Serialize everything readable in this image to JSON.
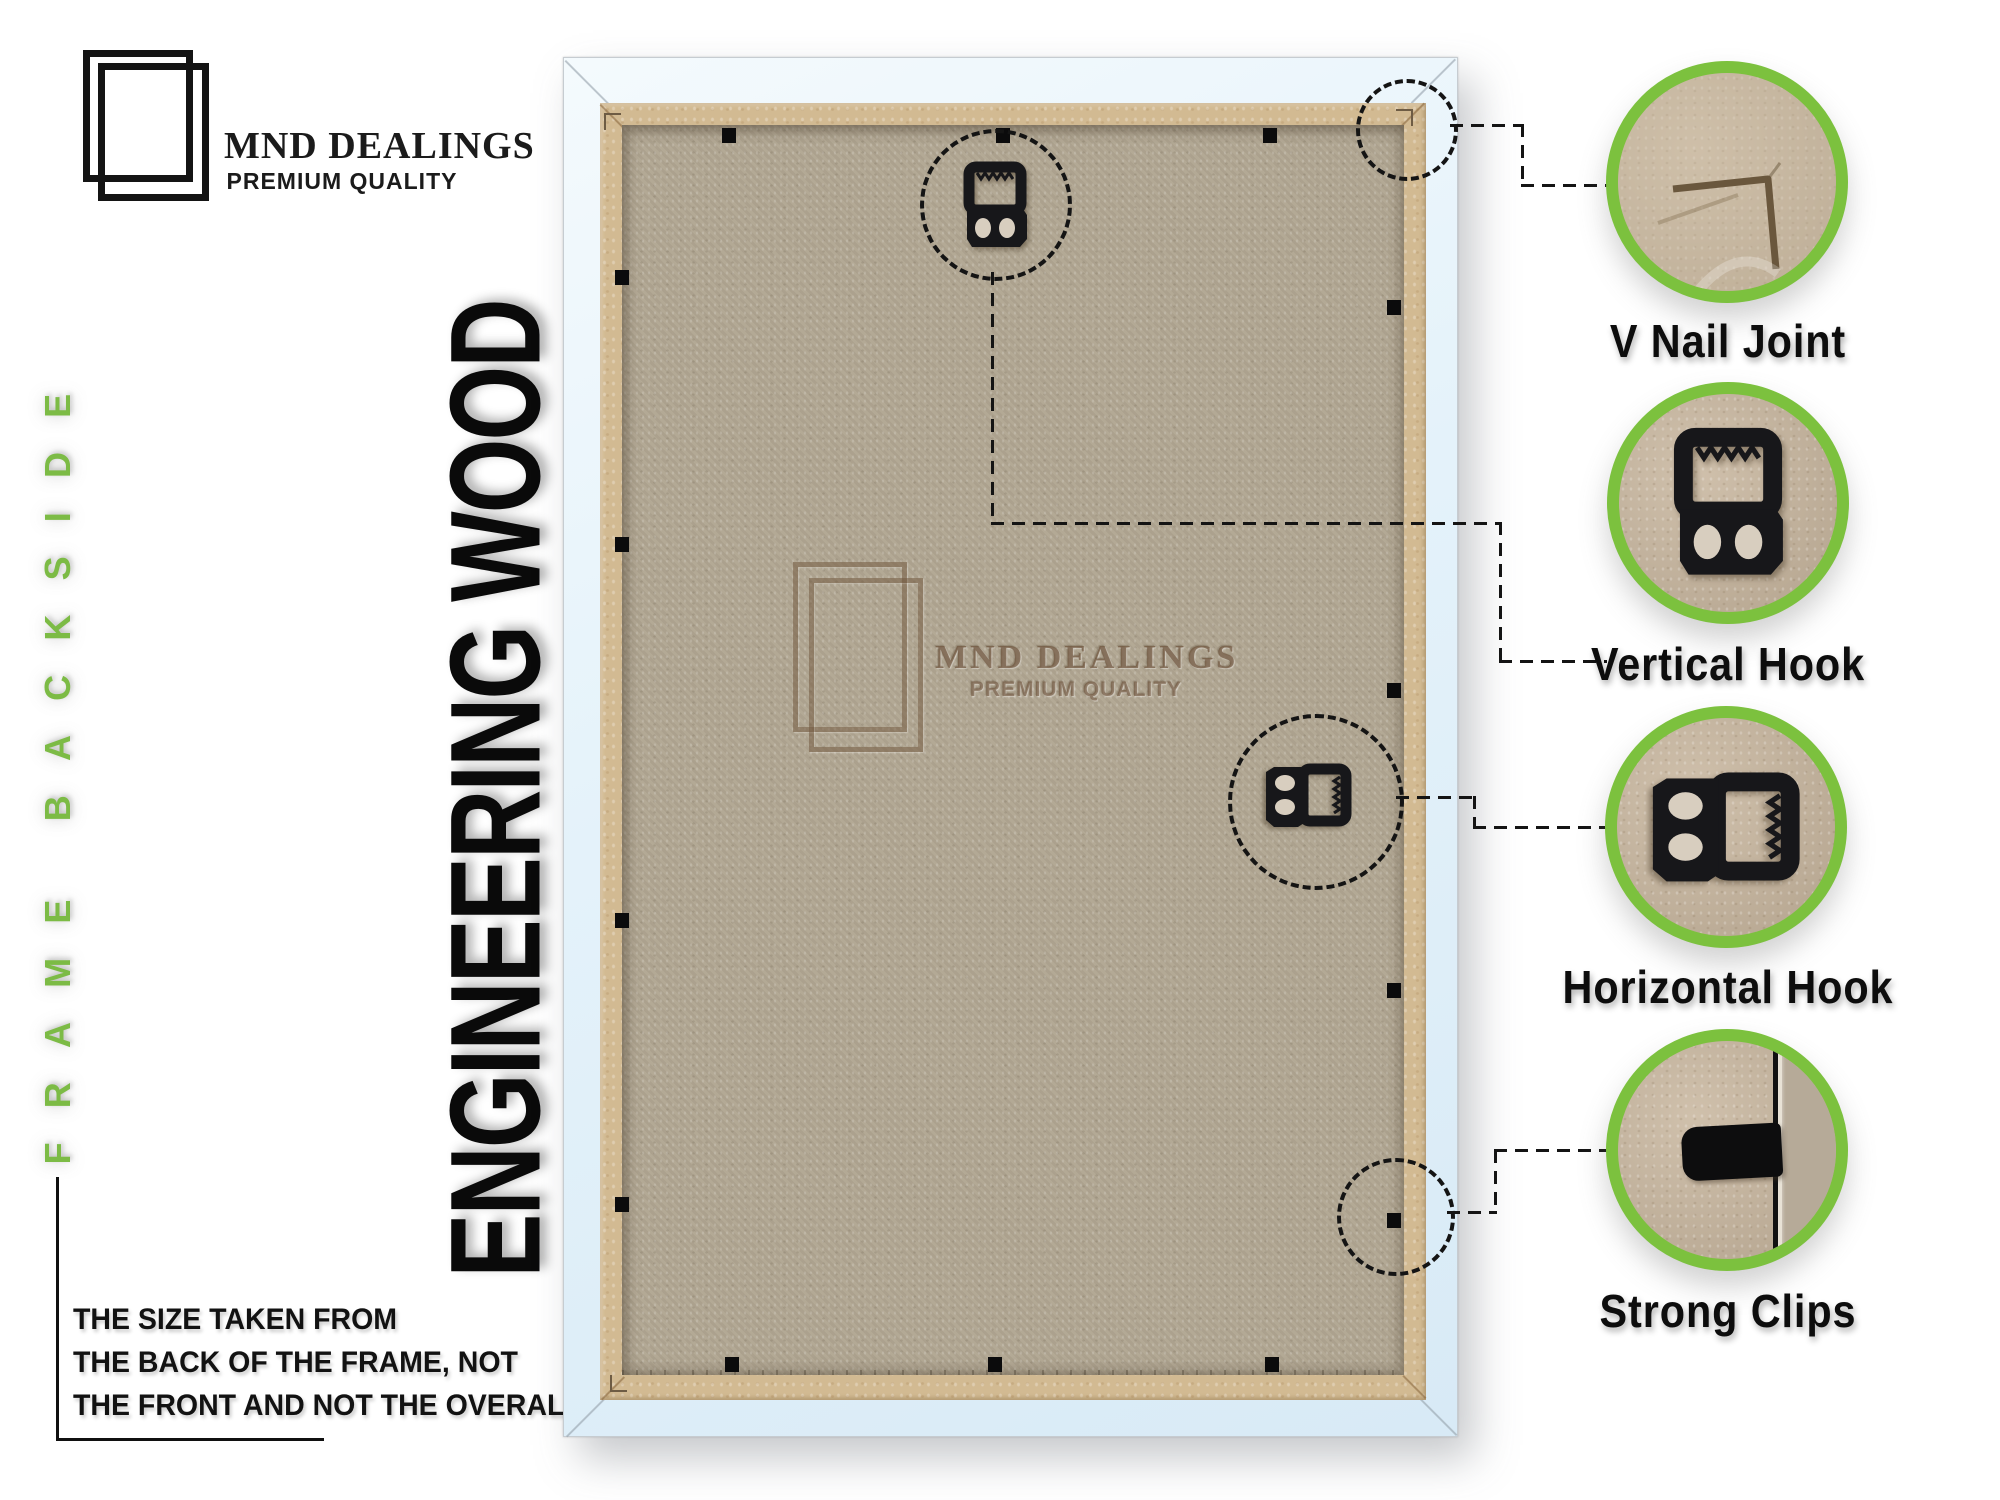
{
  "brand": {
    "name": "MND DEALINGS",
    "tagline": "PREMIUM QUALITY"
  },
  "side_label": "FRAME BACKSIDE",
  "headline": "ENGINEERING WOOD",
  "size_note": {
    "lines": [
      "THE SIZE TAKEN FROM",
      "THE BACK OF THE FRAME, NOT",
      "THE FRONT AND NOT THE OVERALL SIZE."
    ]
  },
  "watermark": {
    "name": "MND DEALINGS",
    "tagline": "PREMIUM QUALITY"
  },
  "callouts": [
    {
      "label": "V Nail Joint",
      "icon": "v-nail-joint-photo"
    },
    {
      "label": "Vertical Hook",
      "icon": "vertical-hook-photo"
    },
    {
      "label": "Horizontal Hook",
      "icon": "horizontal-hook-photo"
    },
    {
      "label": "Strong Clips",
      "icon": "strong-clip-photo"
    }
  ],
  "colors": {
    "accent_green": "#7cc13e",
    "label_green": "#7cbb45",
    "frame_white": "#e4f2fa",
    "trim_tan": "#d2ba92",
    "board_tan": "#b1a692",
    "hook_black": "#17171a",
    "dash_black": "#141414"
  }
}
